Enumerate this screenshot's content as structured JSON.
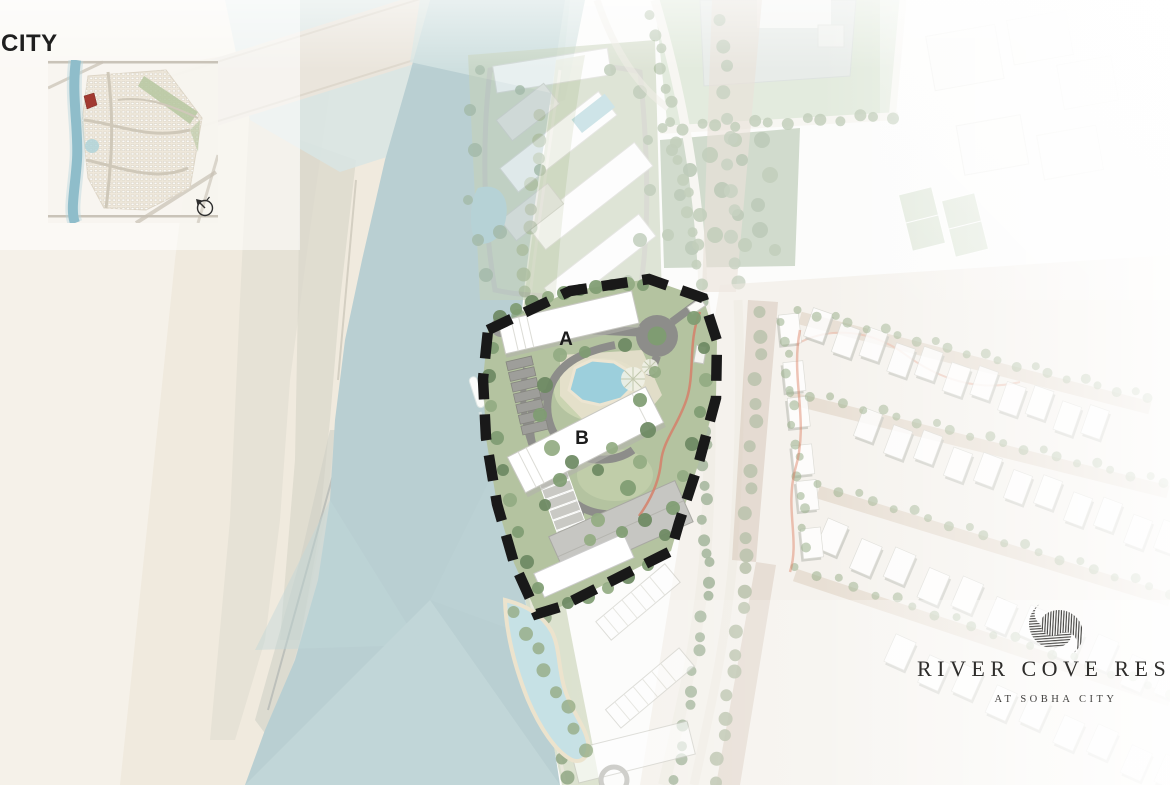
{
  "header": {
    "title": "CITY"
  },
  "map": {
    "building_a_label": "A",
    "building_b_label": "B"
  },
  "logo": {
    "title": "RIVER COVE RESIDENCE",
    "subtitle": "AT SOBHA CITY"
  },
  "colors": {
    "title-ink": "#1f1f1f",
    "logo-ink": "#2e2d2b",
    "river": "#b9cfd2",
    "lagoon": "#c6e1e5",
    "parcel-green": "#b4c3a0",
    "boundary-black": "#191919",
    "road-gray": "#8d8d8a",
    "pool-blue": "#9ccfdc",
    "accent-path-red": "#d5806a",
    "marker-red": "#a23a31",
    "inset-river": "#8fbdca",
    "sand": "#f0ebe1"
  }
}
